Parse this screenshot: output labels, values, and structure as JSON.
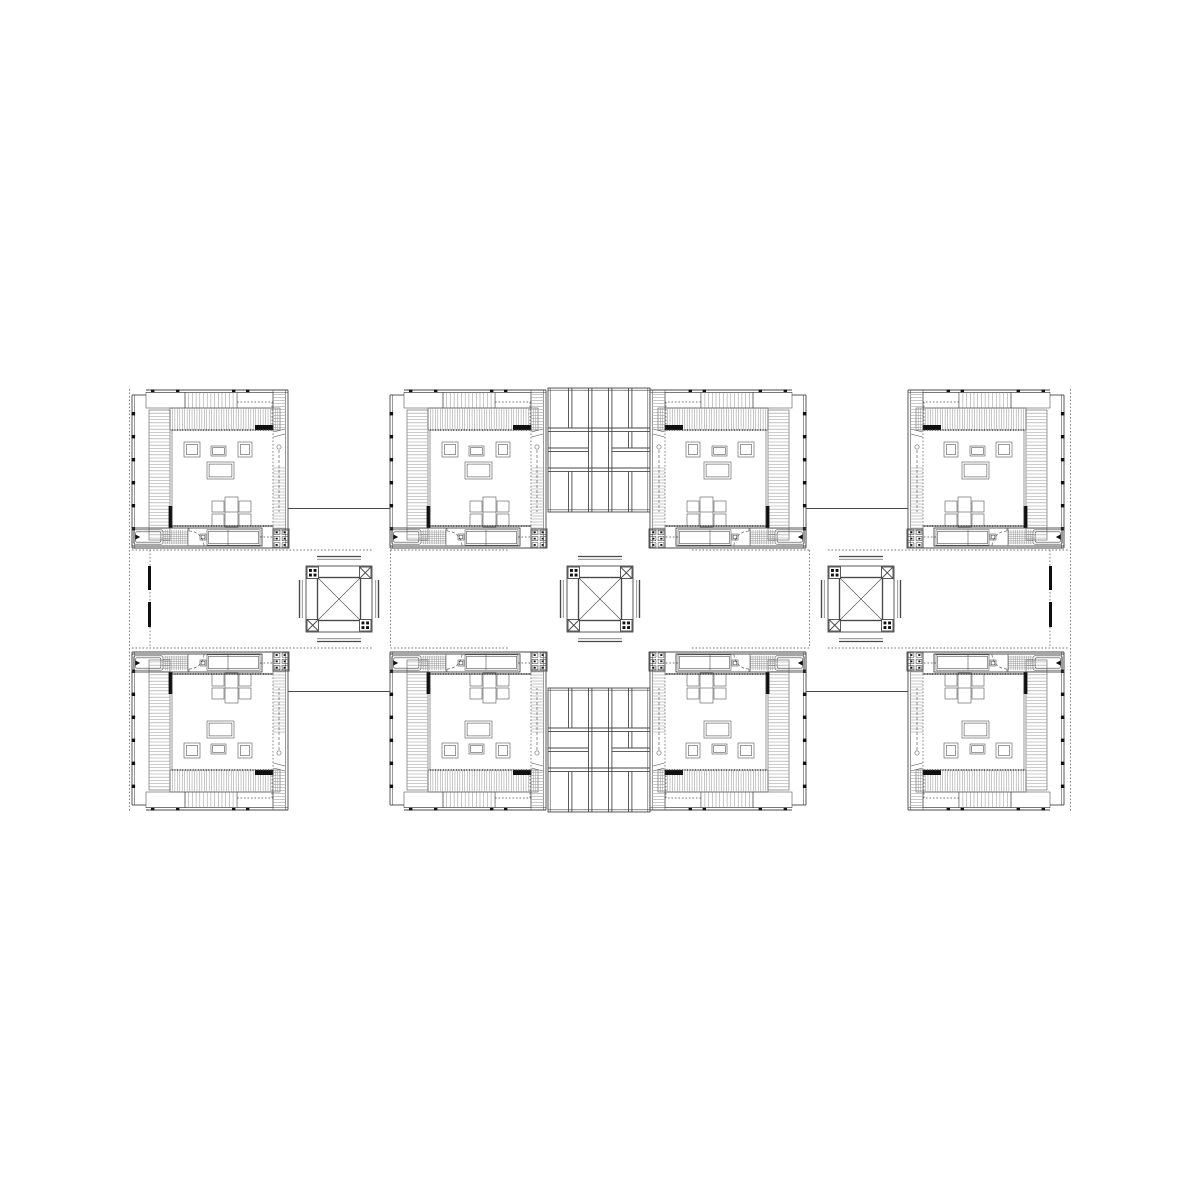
{
  "page": {
    "width": 1200,
    "height": 1200,
    "background": "#ffffff"
  },
  "drawing": {
    "type": "architectural-floor-plan",
    "description_data": {
      "units_count": 8,
      "cores_count": 3,
      "courtyards_count": 4,
      "paving_grids_count": 2
    },
    "colors": {
      "ink": "#474747",
      "hatch": "#9a9a9a",
      "solid": "#101010",
      "paper": "#ffffff"
    },
    "rows": {
      "top_y": 390,
      "bottom_y": 810
    },
    "band": {
      "y1": 550,
      "y2": 648
    },
    "units": [
      {
        "id": 1,
        "tx": 132,
        "ty": 390,
        "sx": 1,
        "sy": 1
      },
      {
        "id": 2,
        "tx": 390,
        "ty": 390,
        "sx": 1,
        "sy": 1
      },
      {
        "id": 3,
        "tx": 806,
        "ty": 390,
        "sx": -1,
        "sy": 1
      },
      {
        "id": 4,
        "tx": 1064,
        "ty": 390,
        "sx": -1,
        "sy": 1
      },
      {
        "id": 5,
        "tx": 132,
        "ty": 810,
        "sx": 1,
        "sy": -1
      },
      {
        "id": 6,
        "tx": 390,
        "ty": 810,
        "sx": 1,
        "sy": -1
      },
      {
        "id": 7,
        "tx": 806,
        "ty": 810,
        "sx": -1,
        "sy": -1
      },
      {
        "id": 8,
        "tx": 1064,
        "ty": 810,
        "sx": -1,
        "sy": -1
      }
    ],
    "unit": {
      "w": 156,
      "h": 158,
      "left_ticks_y": [
        22,
        45,
        68,
        91,
        114,
        137
      ],
      "top_ticks_x": [
        19,
        44,
        100,
        114
      ],
      "roof_rects": [
        [
          14,
          2.4,
          39,
          15.6
        ],
        [
          53,
          2.4,
          52,
          15.6
        ],
        [
          105,
          2.4,
          36,
          15.6
        ]
      ],
      "roof_hatch": {
        "x1": 53,
        "x2": 105,
        "y1": 2.4,
        "y2": 18,
        "step": 3.7
      },
      "roof_dots": [
        [
          105,
          12,
          141,
          12
        ],
        [
          140,
          12,
          140,
          40
        ]
      ],
      "top_louver": {
        "x1": 38,
        "x2": 148,
        "y1": 18,
        "y2": 40,
        "step": 2.45,
        "bar": [
          123,
          35,
          18.5,
          5
        ]
      },
      "left_louver": {
        "x1": 17,
        "x2": 38,
        "y1": 20,
        "y2": 150,
        "step": 3.2,
        "bar": [
          36.6,
          116,
          3.8,
          22
        ]
      },
      "room": [
        40,
        40,
        141,
        136
      ],
      "furniture": [
        {
          "name": "armchair-left",
          "r": [
            52,
            52,
            16,
            15
          ],
          "inset": 2.5
        },
        {
          "name": "coffee-table",
          "r": [
            79,
            56,
            15,
            10
          ],
          "inset": 1.6
        },
        {
          "name": "armchair-right",
          "r": [
            106,
            52,
            14,
            15
          ],
          "inset": 2.5
        },
        {
          "name": "sofa",
          "r": [
            75,
            72,
            27,
            17
          ],
          "inset": 2.1
        },
        {
          "name": "dining-table",
          "r": [
            93,
            107,
            13,
            30
          ],
          "inset": 0,
          "midline": 122
        }
      ],
      "chairs": [
        [
          80,
          111,
          12,
          11
        ],
        [
          80,
          124,
          12,
          12
        ],
        [
          107,
          111,
          12,
          11
        ],
        [
          107,
          124,
          12,
          12
        ]
      ],
      "stair": {
        "x1": 141,
        "x2": 153.4,
        "runs": [
          [
            4.5,
            38
          ],
          [
            78,
            145.5
          ]
        ],
        "step": 3,
        "guide": [
          147,
          60,
          122
        ],
        "circle": [
          147,
          57,
          2.1
        ],
        "breaks": [
          [
            141.5,
            42,
            153,
            39
          ],
          [
            141.5,
            47,
            153,
            44
          ]
        ]
      },
      "service_box": {
        "r": [
          141,
          139,
          16,
          19
        ],
        "cols": 2,
        "rows": 3
      },
      "entry": {
        "box": [
          0,
          138,
          130,
          18
        ],
        "tub": [
          1.5,
          139.8,
          29.5,
          14.4
        ],
        "tiles": {
          "x1": 31,
          "x2": 56,
          "y1": 139.8,
          "y2": 154.2,
          "step": 2.2
        },
        "door_x": 57,
        "door_r": 15,
        "wc": [
          68,
          144,
          6,
          6
        ],
        "wardrobe": [
          75,
          139.8,
          53,
          15.4
        ],
        "divider_x": 96,
        "dot_link": [
          128,
          147,
          141,
          147
        ]
      }
    },
    "cores": [
      {
        "id": 1,
        "cx": 339,
        "cy": 599
      },
      {
        "id": 2,
        "cx": 600,
        "cy": 599
      },
      {
        "id": 3,
        "cx": 861,
        "cy": 599
      }
    ],
    "core_geom": {
      "outer_half": 33,
      "square_half": 21.5,
      "box": 11.5,
      "flank_v_off": [
        36.8,
        39.5
      ],
      "flank_v_half": 19,
      "flank_h_off": [
        39.8,
        42.5
      ],
      "flank_h_half": 22
    },
    "courtyards": [
      {
        "id": 1,
        "x1": 132,
        "x2": 372,
        "wall_x": 372,
        "wall_w": 2.6,
        "balcony_x": 150,
        "bars_x": 148,
        "bars": [
          [
            566,
            590
          ],
          [
            602,
            627
          ]
        ]
      },
      {
        "id": 2,
        "x1": 390.5,
        "x2": 508,
        "wall_x": 508,
        "wall_w": 1.8,
        "open_edge": 390.5
      },
      {
        "id": 3,
        "x1": 692,
        "x2": 809.5,
        "wall_x": 692,
        "wall_w": 1.8,
        "open_edge": 809.5
      },
      {
        "id": 4,
        "x1": 828,
        "x2": 1068,
        "wall_x": 828,
        "wall_w": 2.6,
        "balcony_x": 1050,
        "bars_x": 1049,
        "bars": [
          [
            566,
            590
          ],
          [
            602,
            627
          ]
        ]
      }
    ],
    "paving_grids": [
      {
        "id": "top",
        "x": 548,
        "y": 388
      },
      {
        "id": "bottom",
        "x": 548,
        "y": 688
      }
    ],
    "grid_geom": {
      "w": 102,
      "h": 124,
      "seps": [
        40,
        60,
        80
      ],
      "sep_gap": 3.4,
      "cols": [
        20.5,
        40.5,
        60.5,
        80.5
      ],
      "r1_end": 40,
      "r4_start": 83.4,
      "split_sep": 60,
      "left_end": 40.5,
      "right_start": 63.9,
      "extra_col": 80.5,
      "extra_rows": [
        43.4,
        60
      ]
    },
    "connectors": [
      {
        "x1": 288,
        "y1": 508.5,
        "x2": 390,
        "y2": 508.5
      },
      {
        "x1": 806,
        "y1": 508.5,
        "x2": 908,
        "y2": 508.5
      },
      {
        "x1": 288,
        "y1": 691.5,
        "x2": 390,
        "y2": 691.5
      },
      {
        "x1": 806,
        "y1": 691.5,
        "x2": 908,
        "y2": 691.5
      }
    ],
    "site_edges": [
      {
        "x": 129.5,
        "y1": 389,
        "y2": 811
      },
      {
        "x": 1070.5,
        "y1": 389,
        "y2": 811
      }
    ]
  }
}
